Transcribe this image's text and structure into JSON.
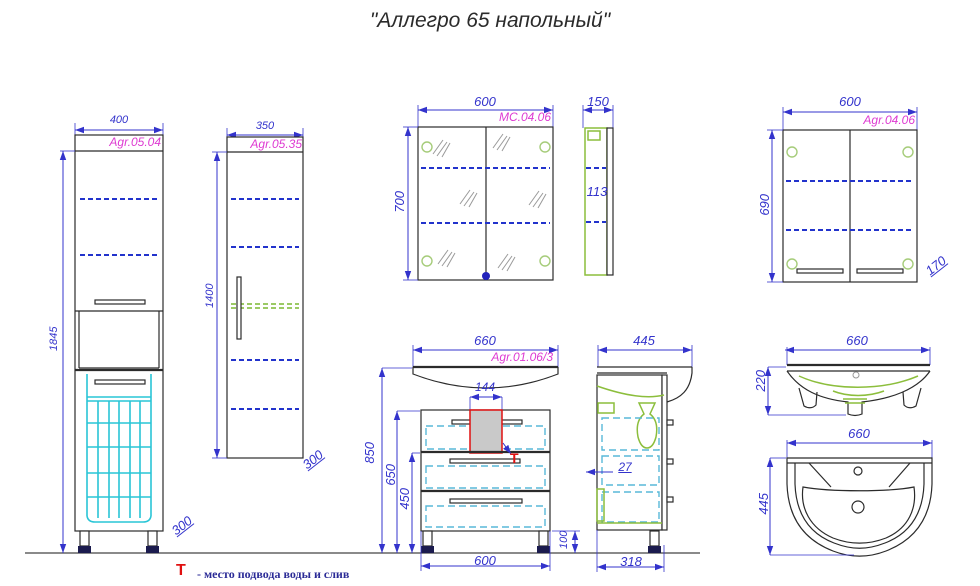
{
  "title": "\"Аллегро 65 напольный\"",
  "legend": {
    "symbol": "Т",
    "text": "- место подвода воды и слив"
  },
  "tall_cabinet": {
    "article": "Agr.05.04",
    "width": "400",
    "height": "1845",
    "depth": "300"
  },
  "mid_cabinet": {
    "article": "Agr.05.35",
    "width": "350",
    "height": "1400",
    "depth": "300"
  },
  "mirror_cabinet": {
    "article": "МС.04.06",
    "width": "600",
    "height": "700",
    "side_depth": "150",
    "side_inner": "113"
  },
  "wall_cabinet": {
    "article": "Agr.04.06",
    "width": "600",
    "height": "690",
    "depth": "170"
  },
  "vanity": {
    "article": "Agr.01.06/3",
    "width": "660",
    "cutout_width": "144",
    "height_total": "850",
    "height_mid": "650",
    "height_drawer": "450",
    "body_width": "600",
    "leg_height": "100",
    "supply_symbol": "Т",
    "side_width": "445",
    "side_gap": "27",
    "side_body_width": "318"
  },
  "sink_front": {
    "width": "660",
    "height": "220"
  },
  "sink_top": {
    "width": "660",
    "depth": "445"
  },
  "colors": {
    "dimension": "#3333cc",
    "article": "#de3ad2",
    "outline": "#2b2b2b",
    "basket": "#29c5d6",
    "drawer_outline": "#58b8d8",
    "fitting_green": "#8cbe3c",
    "accent_red": "#e01010",
    "supply_fill": "#c9c9c9"
  }
}
